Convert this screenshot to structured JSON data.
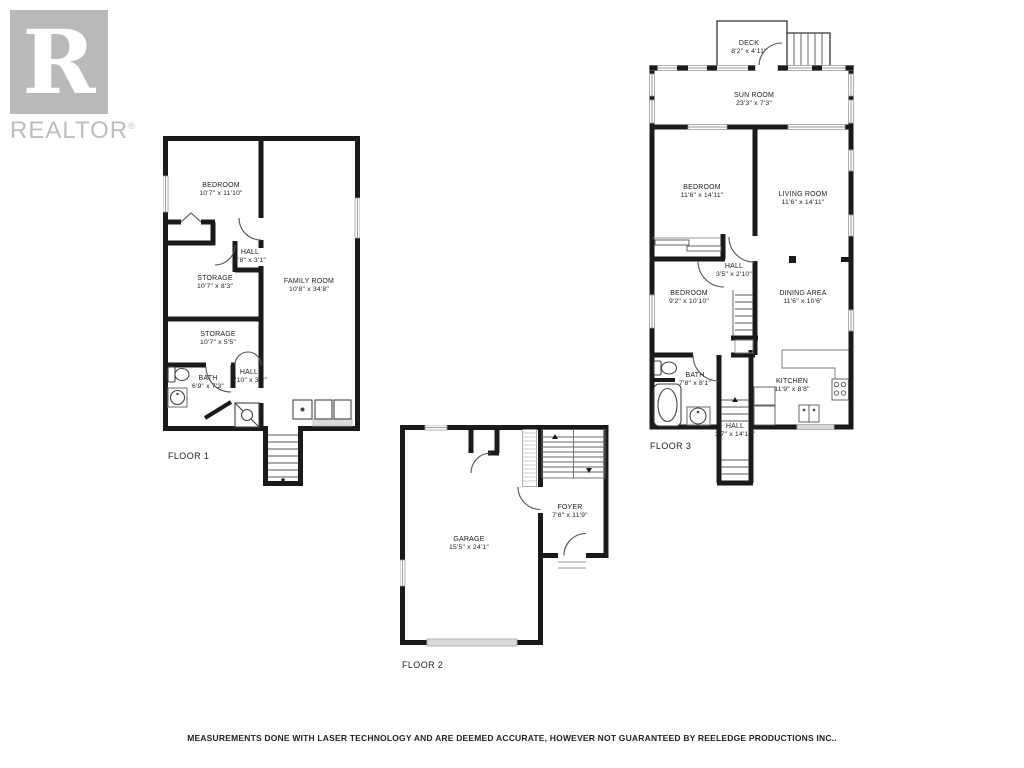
{
  "branding": {
    "logo_letter": "R",
    "logo_label": "REALTOR",
    "registered_mark": "®"
  },
  "floors": [
    {
      "label": "FLOOR 1",
      "rooms": [
        {
          "name": "BEDROOM",
          "dims": "10'7\" x 11'10\""
        },
        {
          "name": "HALL",
          "dims": "3'8\" x 3'1\""
        },
        {
          "name": "STORAGE",
          "dims": "10'7\" x 8'3\""
        },
        {
          "name": "FAMILY ROOM",
          "dims": "10'8\" x 34'8\""
        },
        {
          "name": "STORAGE",
          "dims": "10'7\" x 5'5\""
        },
        {
          "name": "BATH",
          "dims": "6'9\" x 7'3\""
        },
        {
          "name": "HALL",
          "dims": "3'10\" x 3'2\""
        }
      ]
    },
    {
      "label": "FLOOR 2",
      "rooms": [
        {
          "name": "GARAGE",
          "dims": "15'5\" x 24'1\""
        },
        {
          "name": "FOYER",
          "dims": "7'6\" x 11'9\""
        }
      ]
    },
    {
      "label": "FLOOR 3",
      "rooms": [
        {
          "name": "DECK",
          "dims": "8'2\" x 4'11\""
        },
        {
          "name": "SUN ROOM",
          "dims": "23'3\" x 7'3\""
        },
        {
          "name": "BEDROOM",
          "dims": "11'6\" x 14'11\""
        },
        {
          "name": "LIVING ROOM",
          "dims": "11'6\" x 14'11\""
        },
        {
          "name": "HALL",
          "dims": "3'5\" x 2'10\""
        },
        {
          "name": "BEDROOM",
          "dims": "9'2\" x 10'10\""
        },
        {
          "name": "DINING AREA",
          "dims": "11'6\" x 10'6\""
        },
        {
          "name": "BATH",
          "dims": "7'8\" x 8'1\""
        },
        {
          "name": "KITCHEN",
          "dims": "11'9\" x 8'8\""
        },
        {
          "name": "HALL",
          "dims": "3'7\" x 14'10\""
        }
      ]
    }
  ],
  "disclaimer": "MEASUREMENTS DONE WITH LASER TECHNOLOGY AND ARE DEEMED ACCURATE, HOWEVER NOT GUARANTEED BY REELEDGE PRODUCTIONS INC..",
  "colors": {
    "wall": "#1a1a1a",
    "thin_line": "#555555",
    "window_line": "#999999",
    "logo_gray": "#b9b9b9",
    "garage_door_fill": "#d9d9d9",
    "patio_door_fill": "#d9d9d9",
    "text": "#222222"
  }
}
